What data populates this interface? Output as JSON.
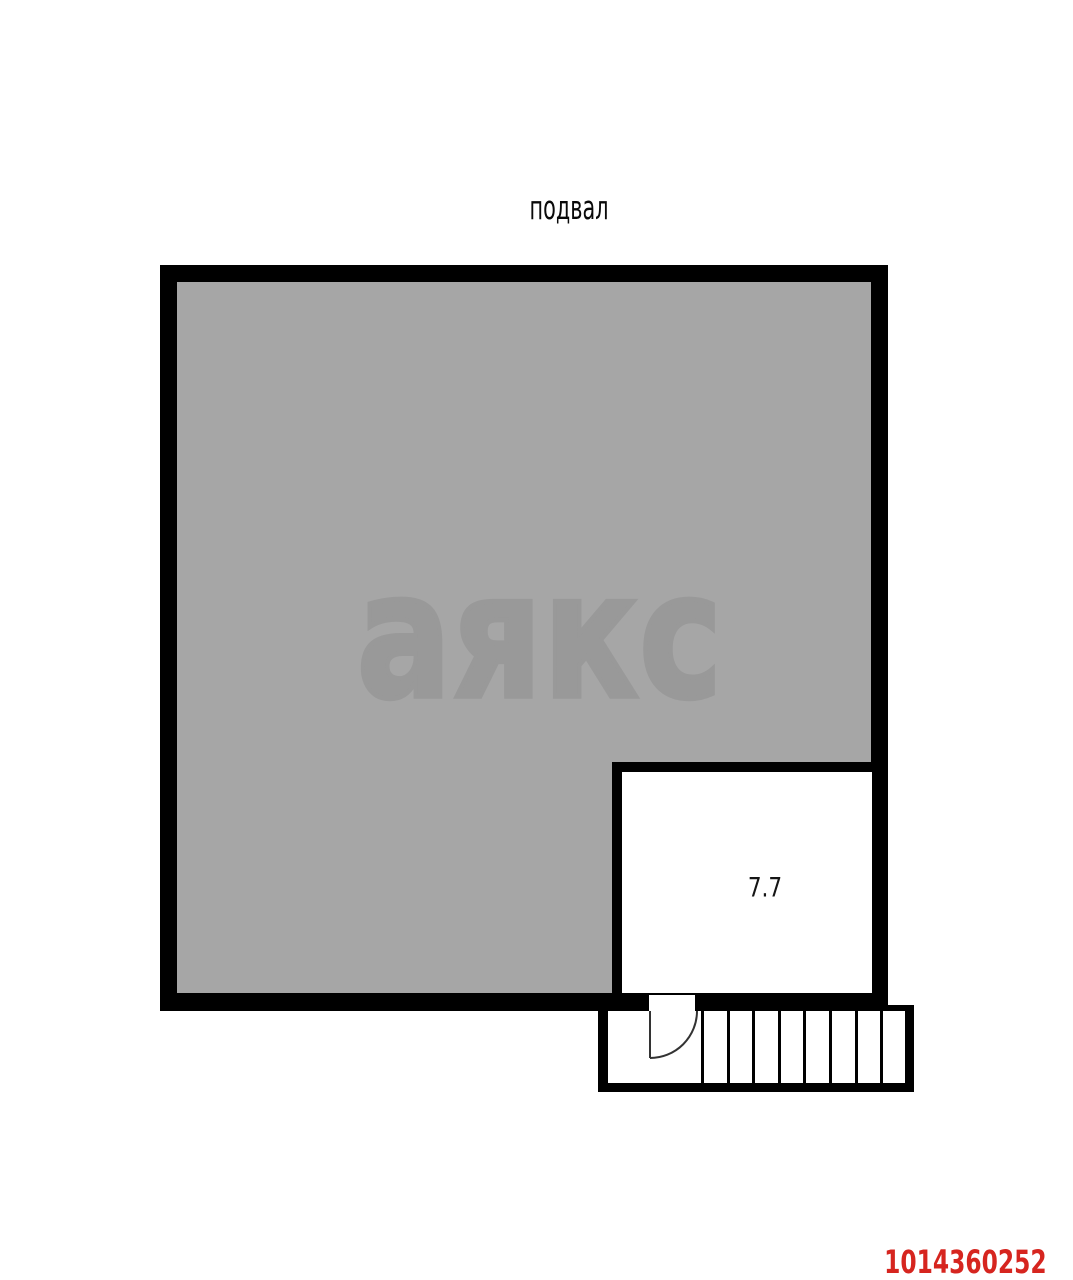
{
  "floor_plan": {
    "floor_label": "подвал",
    "watermark_text": "аякс",
    "listing_id": "1014360252",
    "rooms": [
      {
        "name": "storage-room",
        "area_label": "7.7",
        "fill": "#ffffff"
      }
    ],
    "staircase": {
      "tread_count": 8,
      "has_door_swing": true
    },
    "colors": {
      "wall_black": "#000000",
      "floor_gray": "#a6a6a6",
      "watermark_gray": "#999999",
      "room_white": "#ffffff",
      "listing_id_red": "#d6251f",
      "door_stroke": "#333333"
    }
  }
}
